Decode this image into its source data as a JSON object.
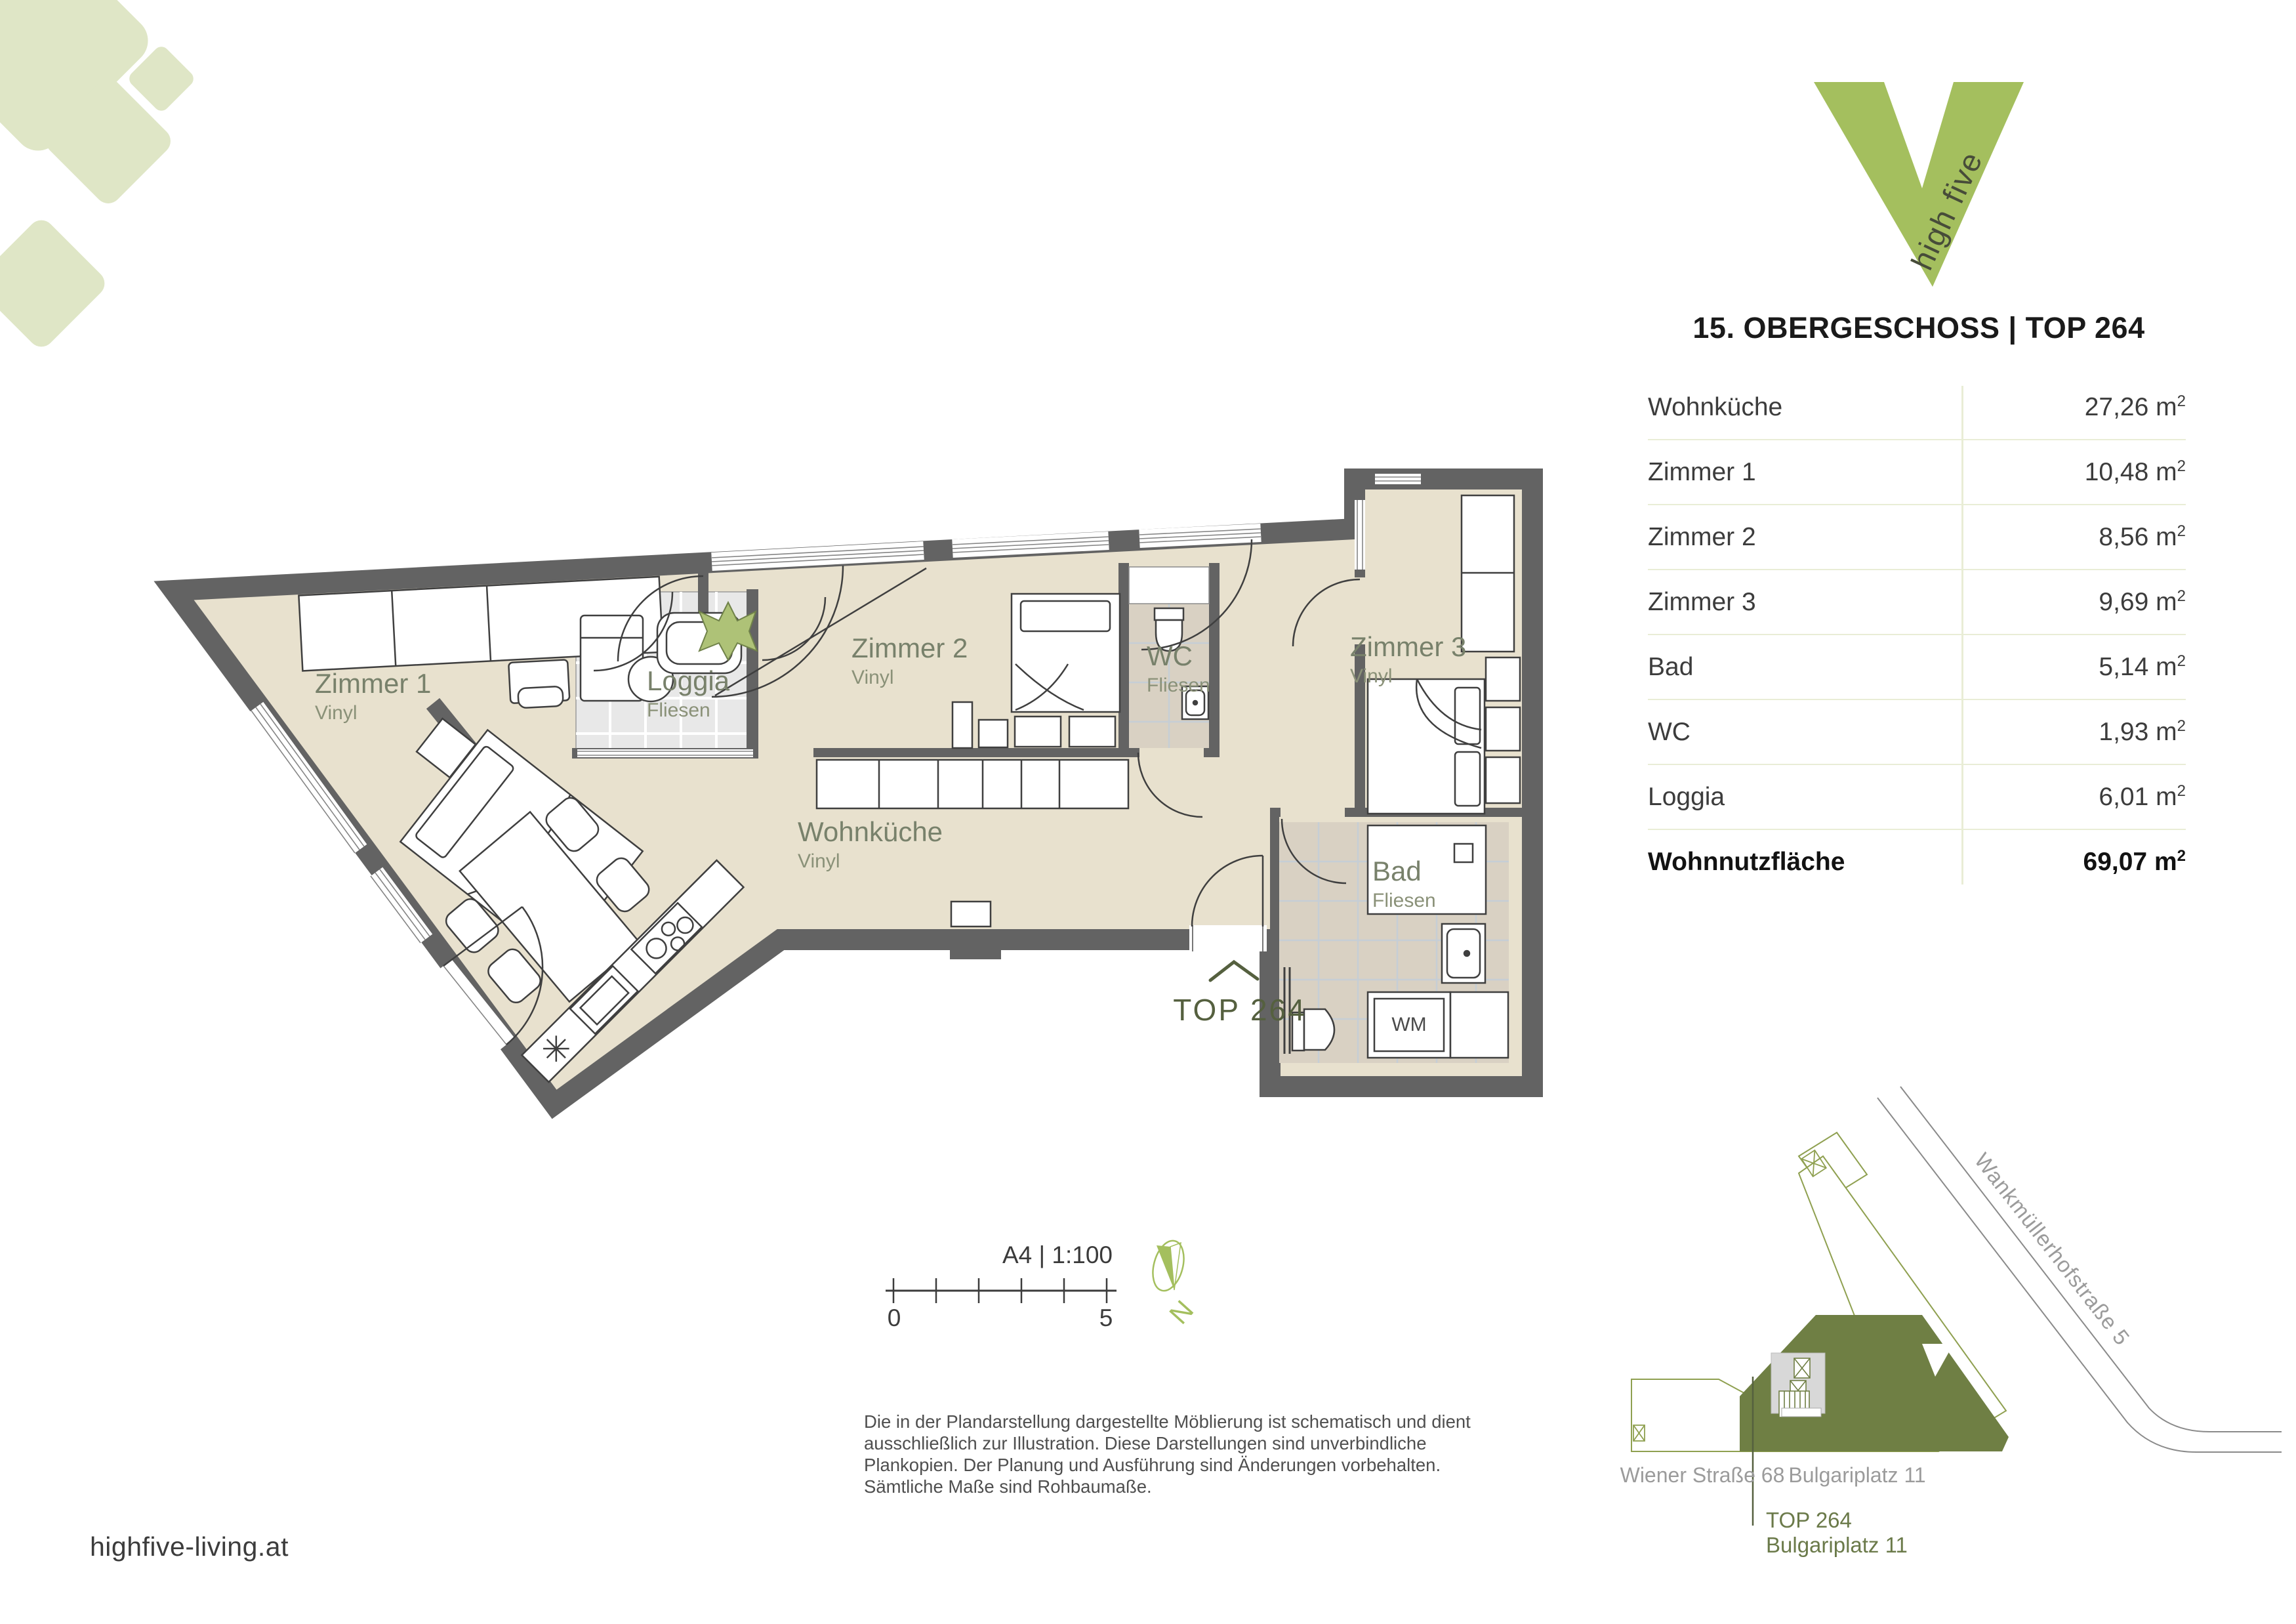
{
  "brand": {
    "v_letter": "V",
    "name": "high five",
    "website": "highfive-living.at"
  },
  "header": {
    "title": "15. OBERGESCHOSS | TOP 264"
  },
  "area_table": {
    "unit": "m",
    "unit_exp": "2",
    "rows": [
      {
        "label": "Wohnküche",
        "value": "27,26"
      },
      {
        "label": "Zimmer 1",
        "value": "10,48"
      },
      {
        "label": "Zimmer 2",
        "value": "8,56"
      },
      {
        "label": "Zimmer 3",
        "value": "9,69"
      },
      {
        "label": "Bad",
        "value": "5,14"
      },
      {
        "label": "WC",
        "value": "1,93"
      },
      {
        "label": "Loggia",
        "value": "6,01"
      }
    ],
    "total": {
      "label": "Wohnnutzfläche",
      "value": "69,07"
    }
  },
  "plan": {
    "unit_label": "TOP 264",
    "appliance_label": "WM",
    "rooms": [
      {
        "name": "Zimmer 1",
        "floor": "Vinyl"
      },
      {
        "name": "Loggia",
        "floor": "Fliesen"
      },
      {
        "name": "Zimmer 2",
        "floor": "Vinyl"
      },
      {
        "name": "WC",
        "floor": "Fliesen"
      },
      {
        "name": "Zimmer 3",
        "floor": "Vinyl"
      },
      {
        "name": "Wohnküche",
        "floor": "Vinyl"
      },
      {
        "name": "Bad",
        "floor": "Fliesen"
      }
    ]
  },
  "scalebar": {
    "sheet": "A4 | 1:100",
    "start": "0",
    "end": "5"
  },
  "compass": {
    "north": "N"
  },
  "disclaimer": {
    "lines": [
      "Die in der Plandarstellung dargestellte Möblierung ist schematisch und dient",
      "ausschließlich zur Illustration. Diese Darstellungen sind unverbindliche",
      "Plankopien. Der Planung und Ausführung sind Änderungen vorbehalten.",
      "Sämtliche Maße sind Rohbaumaße."
    ]
  },
  "siteplan": {
    "street": "Wankmüllerhofstraße 5",
    "building_left": "Wiener Straße 68",
    "building_right": "Bulgariplatz 11",
    "callout": {
      "line1": "TOP 264",
      "line2": "Bulgariplatz 11"
    }
  },
  "colors": {
    "brand_green": "#a4bf5e",
    "pale_green": "#dfe6c6",
    "olive_fill": "#6f7f44",
    "wall_gray": "#636363",
    "floor_beige": "#e8e1ce",
    "tile_light": "#e8e8e8",
    "tile_greige": "#d9d1c3",
    "label_green": "#78816b"
  }
}
